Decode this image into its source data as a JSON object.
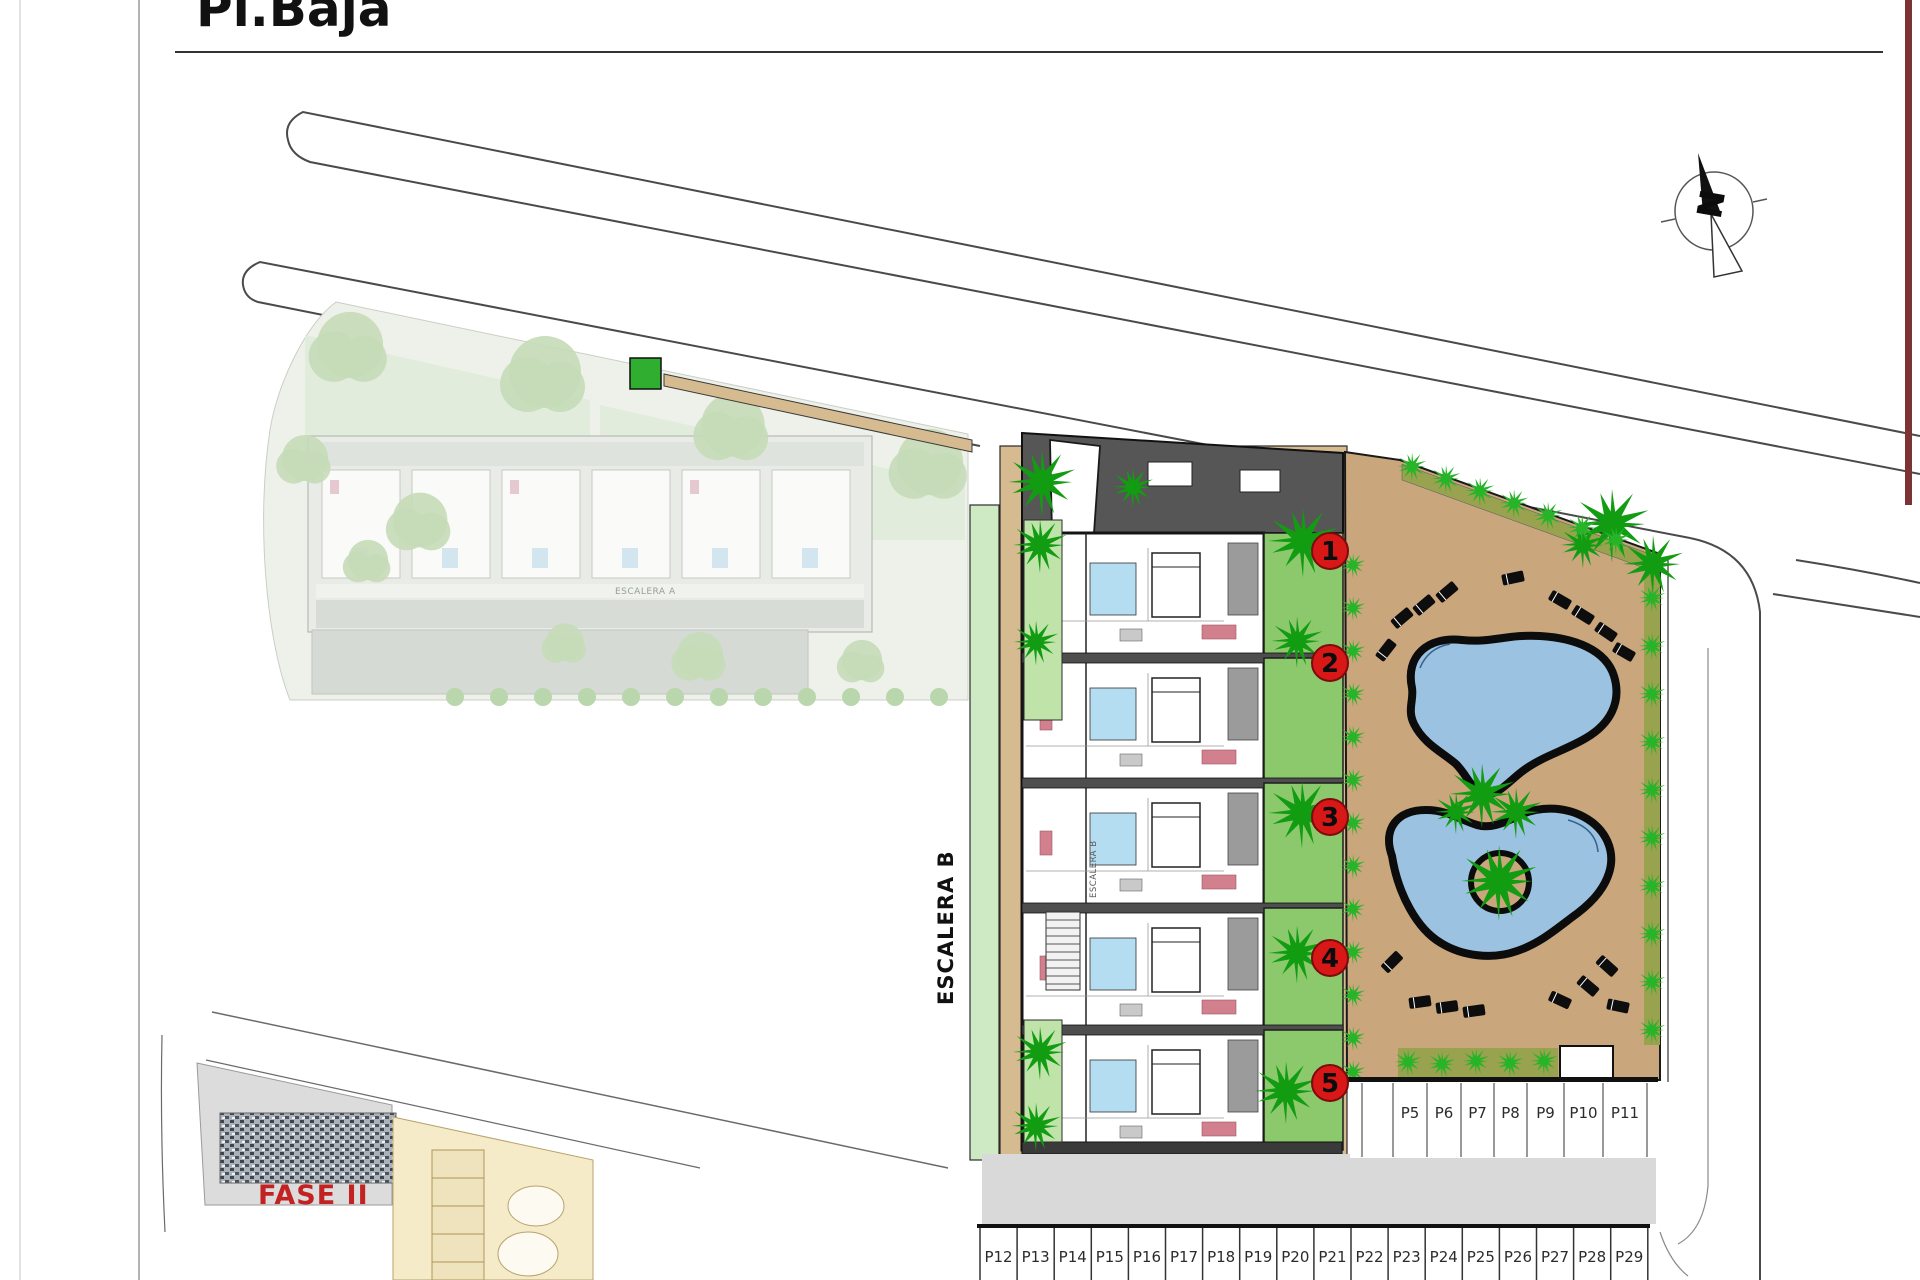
{
  "title": "Pl.Baja",
  "plan_labels": {
    "escalera_b": "ESCALERA B",
    "escalera_a": "ESCALERA A",
    "fase_ii": "FASE II",
    "north_letter": "N"
  },
  "unit_badges": [
    "1",
    "2",
    "3",
    "4",
    "5"
  ],
  "parking": {
    "right_row": [
      "P5",
      "P6",
      "P7",
      "P8",
      "P9",
      "P10",
      "P11"
    ],
    "bottom_row": [
      "P12",
      "P13",
      "P14",
      "P15",
      "P16",
      "P17",
      "P18",
      "P19",
      "P20",
      "P21",
      "P22",
      "P23",
      "P24",
      "P25",
      "P26",
      "P27",
      "P28",
      "P29"
    ]
  },
  "colors": {
    "badge_red": "#d81717",
    "badge_red_edge": "#7e0b0b",
    "fase_red": "#c32222",
    "pool_blue": "#9cc2e2",
    "garden_green": "#8cc96d",
    "palm_green": "#129c12",
    "bush_green": "#28b428",
    "ground_tan": "#c9a67c",
    "building_tan": "#d6ba90",
    "hedge_olive": "#99a24e",
    "road_line": "#4a4a4a",
    "aisle_gray": "#d9d9d9",
    "faded_parcel": "#eef1ea",
    "faded_tree": "#c5dcb8"
  }
}
